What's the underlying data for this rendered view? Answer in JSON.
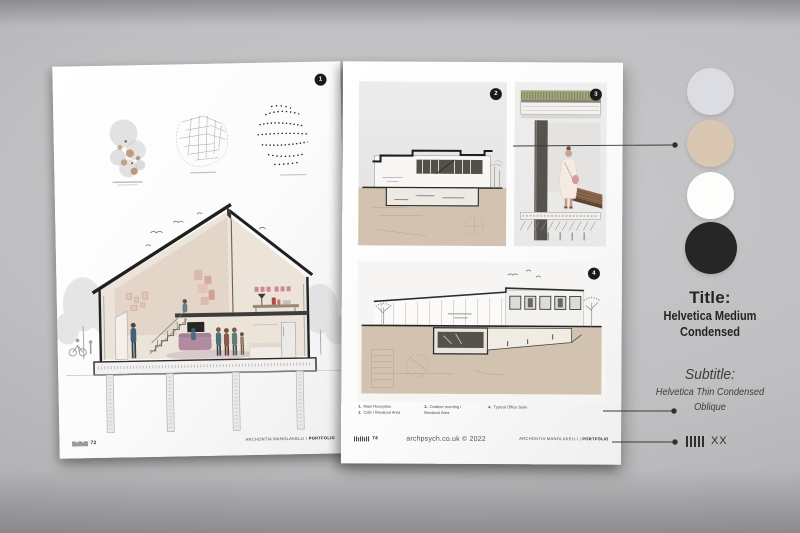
{
  "left_page": {
    "badge": "1",
    "footer": {
      "page_number": "72",
      "credit_name": "ARCHONTIA MANOLAKELLI",
      "credit_divider": "|",
      "credit_bold": "PORTFOLIO"
    }
  },
  "right_page": {
    "panel_section_badge": "2",
    "panel_detail_badge": "3",
    "panel_longsect_badge": "4",
    "legend": {
      "item1_num": "1.",
      "item1_label": "Main Reception",
      "item2_num": "2.",
      "item2_label": "Cafe / Breakout Area",
      "item3_num": "3.",
      "item3_label": "Outdoor meeting / Breakout Area",
      "item4_num": "4.",
      "item4_label": "Typical Office Suite"
    },
    "footer": {
      "page_number": "74",
      "copyright": "archpsych.co.uk © 2022",
      "credit_name": "ARCHONTIA MANOLAKELLI",
      "credit_divider": "|",
      "credit_bold": "PORTFOLIO"
    }
  },
  "sidebar": {
    "swatches": [
      {
        "name": "lavender-gray",
        "color": "#dcdce3"
      },
      {
        "name": "beige",
        "color": "#d9c7b1"
      },
      {
        "name": "white",
        "color": "#fdfdfc"
      },
      {
        "name": "black",
        "color": "#262626"
      }
    ],
    "title_heading": "Title:",
    "title_line1": "Helvetica Medium",
    "title_line2": "Condensed",
    "subtitle_heading": "Subtitle:",
    "subtitle_line1": "Helvetica Thin Condensed",
    "subtitle_line2": "Oblique",
    "page_marker_label": "XX"
  }
}
